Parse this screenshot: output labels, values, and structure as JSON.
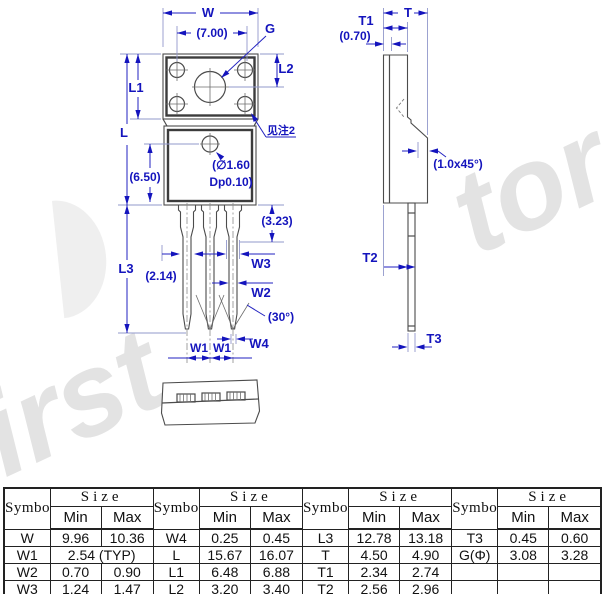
{
  "watermark": {
    "bottom_left": "first",
    "top_right": "tor"
  },
  "front_view": {
    "w": "W",
    "g": "G",
    "l1": "L1",
    "l2": "L2",
    "l": "L",
    "l3": "L3",
    "d700": "(7.00)",
    "d650": "(6.50)",
    "d323": "(3.23)",
    "d214": "(2.14)",
    "hole_note_1": "(∅1.60",
    "hole_note_2": "Dp0.10)",
    "see_note": "见注2",
    "w1a": "W1",
    "w1b": "W1",
    "w2": "W2",
    "w3": "W3",
    "w4": "W4",
    "angle30": "(30°)"
  },
  "side_view": {
    "t": "T",
    "t1": "T1",
    "t2": "T2",
    "t3": "T3",
    "d070": "(0.70)",
    "chamfer": "(1.0x45°)"
  },
  "table": {
    "h_symbol": "Symbol",
    "h_size": "Size",
    "h_min": "Min",
    "h_max": "Max",
    "g0": {
      "r0": {
        "s": "W",
        "mn": "9.96",
        "mx": "10.36"
      },
      "r1": {
        "s": "W1",
        "typ": "2.54 (TYP)"
      },
      "r2": {
        "s": "W2",
        "mn": "0.70",
        "mx": "0.90"
      },
      "r3": {
        "s": "W3",
        "mn": "1.24",
        "mx": "1.47"
      }
    },
    "g1": {
      "r0": {
        "s": "W4",
        "mn": "0.25",
        "mx": "0.45"
      },
      "r1": {
        "s": "L",
        "mn": "15.67",
        "mx": "16.07"
      },
      "r2": {
        "s": "L1",
        "mn": "6.48",
        "mx": "6.88"
      },
      "r3": {
        "s": "L2",
        "mn": "3.20",
        "mx": "3.40"
      }
    },
    "g2": {
      "r0": {
        "s": "L3",
        "mn": "12.78",
        "mx": "13.18"
      },
      "r1": {
        "s": "T",
        "mn": "4.50",
        "mx": "4.90"
      },
      "r2": {
        "s": "T1",
        "mn": "2.34",
        "mx": "2.74"
      },
      "r3": {
        "s": "T2",
        "mn": "2.56",
        "mx": "2.96"
      }
    },
    "g3": {
      "r0": {
        "s": "T3",
        "mn": "0.45",
        "mx": "0.60"
      },
      "r1": {
        "s": "G(Φ)",
        "mn": "3.08",
        "mx": "3.28"
      },
      "r2": {
        "s": "",
        "mn": "",
        "mx": ""
      },
      "r3": {
        "s": "",
        "mn": "",
        "mx": ""
      }
    }
  }
}
